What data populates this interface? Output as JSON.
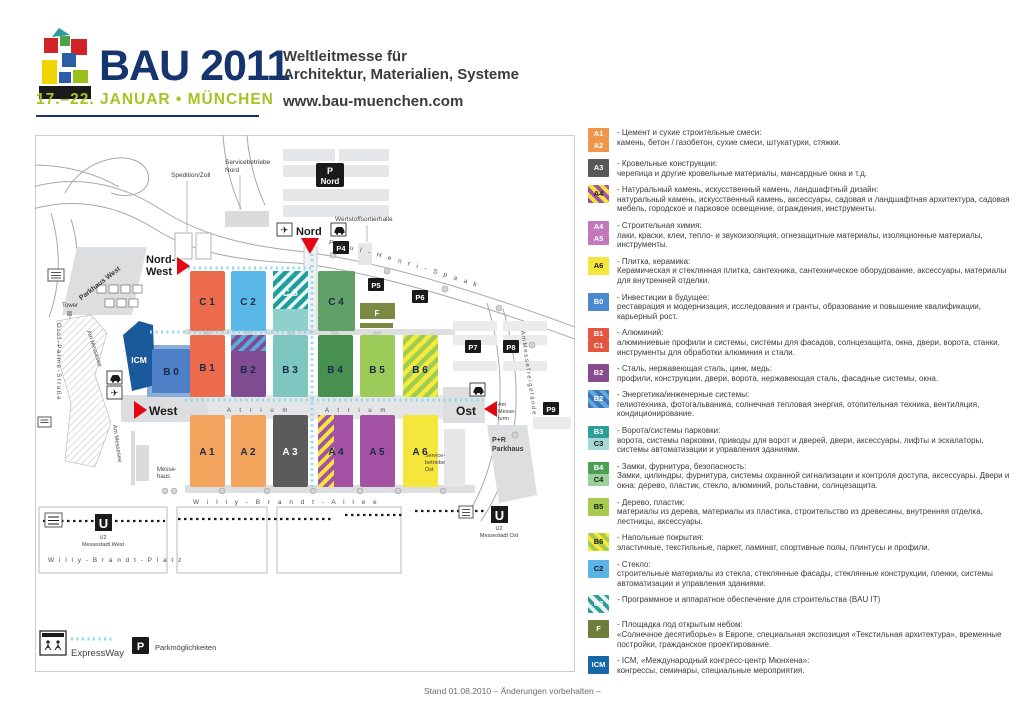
{
  "header": {
    "title": "BAU 2011",
    "dates": "17.–22. JANUAR • MÜNCHEN",
    "claim1": "Weltleitmesse für",
    "claim2": "Architektur, Materialien, Systeme",
    "website": "www.bau-muenchen.com"
  },
  "map": {
    "halls": {
      "c1": "C 1",
      "c2": "C 2",
      "c3": "C 3",
      "c4": "C 4",
      "b0": "B 0",
      "b1": "B 1",
      "b2": "B 2",
      "b3": "B 3",
      "b4": "B 4",
      "b5": "B 5",
      "b6": "B 6",
      "a1": "A 1",
      "a2": "A 2",
      "a3": "A 3",
      "a4": "A 4",
      "a5": "A 5",
      "a6": "A 6",
      "f": "F",
      "icm": "ICM"
    },
    "entrances": {
      "nordwest1": "Nord-",
      "nordwest2": "West",
      "nord": "Nord",
      "west": "West",
      "ost": "Ost"
    },
    "parking": {
      "p_nord1": "P",
      "p_nord2": "Nord",
      "p4": "P4",
      "p5": "P5",
      "p6": "P6",
      "p7": "P7",
      "p8": "P8",
      "p9": "P9",
      "pr1": "P+R",
      "pr2": "Parkhaus",
      "parkhaus_west": "Parkhaus West"
    },
    "streets": {
      "willy_brandt_allee": "W i l l y - B r a n d t - A l l e e",
      "willy_brandt_platz": "W i l l y - B r a n d t - P l a t z",
      "olof_palme": "O l o f - P a l m e - S t r a ß e",
      "paul_henri": "P a u l  -  H e n r i  -  S p a a k",
      "am_messesee": "Am Messesee",
      "am_messeturm1": "Am",
      "am_messeturm2": "Messe-",
      "am_messeturm3": "turm",
      "am_messefreigelaende": "A m  M e s s e f r e i g e l ä n d e",
      "atrium": "A t r i u m"
    },
    "places": {
      "spedition": "Spedition/Zoll",
      "serv_nord1": "Servicebetriebe",
      "serv_nord2": "Nord",
      "wertstoff": "Wertstoffsortierhalle",
      "serv_ost1": "Service-",
      "serv_ost2": "betriebe",
      "serv_ost3": "Ost",
      "messehaus1": "Messe-",
      "messehaus2": "haus",
      "tower": "Tower"
    },
    "stations": {
      "u": "U",
      "west1": "U2",
      "west2": "Messestadt West",
      "ost1": "U2",
      "ost2": "Messestadt Ost"
    },
    "map_legend": {
      "expressway": "ExpressWay",
      "p": "P",
      "parking": "Parkmöglichkeiten"
    }
  },
  "legend": {
    "items": [
      {
        "codes": [
          {
            "text": "A1",
            "bg": "#F0964A",
            "fg": "#FFFFFF"
          },
          {
            "text": "A2",
            "bg": "#F0964A",
            "fg": "#FFFFFF"
          }
        ],
        "title": "- Цемент и сухие строительные смеси:",
        "desc": "камень, бетон / газобетон, сухие смеси, штукатурки, стяжки."
      },
      {
        "codes": [
          {
            "text": "A3",
            "bg": "#58585A",
            "fg": "#FFFFFF"
          }
        ],
        "title": "- Кровельные конструкции:",
        "desc": "черепица и другие кровельные материалы, мансардные окна и т.д."
      },
      {
        "codes": [
          {
            "text": "A4",
            "bg": "repeating-linear-gradient(45deg,#A351A3 0px,#A351A3 4px,#F2E23D 4px,#F2E23D 8px)",
            "fg": "#1A1A1A"
          }
        ],
        "title": "- Натуральный камень, искусственный камень, ландшафтный дизайн:",
        "desc": "натуральный камень, искусственный камень, аксессуары, садовая и ландшафтная архитектура, садовая мебель, городское и парковое освещение, ограждения, инструменты."
      },
      {
        "codes": [
          {
            "text": "A4",
            "bg": "#C378BE",
            "fg": "#FFFFFF"
          },
          {
            "text": "A5",
            "bg": "#C378BE",
            "fg": "#FFFFFF"
          }
        ],
        "title": "- Строительная химия:",
        "desc": "лаки, краски, клеи, тепло- и звукоизоляция, огнезащитные материалы, изоляционные материалы, инструменты."
      },
      {
        "codes": [
          {
            "text": "A6",
            "bg": "#F5E63B",
            "fg": "#1A1A1A"
          }
        ],
        "title": "- Плитка, керамика:",
        "desc": "Керамическая и стеклянная плитка, сантехника, сантехническое оборудование, аксессуары, материалы для внутренней отделки."
      },
      {
        "codes": [
          {
            "text": "B0",
            "bg": "#4A89D0",
            "fg": "#FFFFFF"
          }
        ],
        "title": "- Инвестиции в будущее:",
        "desc": "реставрация и модернизация, исследования и гранты, образование и повышение квалификации, карьерный рост."
      },
      {
        "codes": [
          {
            "text": "B1",
            "bg": "#E65540",
            "fg": "#FFFFFF"
          },
          {
            "text": "C1",
            "bg": "#E65540",
            "fg": "#FFFFFF"
          }
        ],
        "title": "- Алюминий:",
        "desc": "алюминиевые профили и системы, системы для фасадов, солнцезащита, окна, двери, ворота, станки, инструменты для обработки алюминия и стали."
      },
      {
        "codes": [
          {
            "text": "B2",
            "bg": "#8A4A8E",
            "fg": "#FFFFFF"
          }
        ],
        "title": "- Сталь, нержавеющая сталь, цинк, медь:",
        "desc": "профили, конструкции, двери, ворота, нержавеющая сталь, фасадные системы, окна."
      },
      {
        "codes": [
          {
            "text": "B2",
            "bg": "repeating-linear-gradient(45deg,#4472B8 0px,#4472B8 4px,#5FAADE 4px,#5FAADE 8px)",
            "fg": "#FFFFFF"
          }
        ],
        "title": "- Энергетика/инженерные системы:",
        "desc": "гелиотехника, фотогальваника, солнечная тепловая энергия, отопительная техника, вентиляция, кондиционирование."
      },
      {
        "codes": [
          {
            "text": "B3",
            "bg": "#2E9E98",
            "fg": "#FFFFFF"
          },
          {
            "text": "C3",
            "bg": "#A5D8D2",
            "fg": "#1A1A1A"
          }
        ],
        "title": "- Ворота/системы парковки:",
        "desc": "ворота, системы парковки, приводы для ворот и дверей, двери, аксессуары, лифты и эскалаторы, системы автоматизации и управления зданиями."
      },
      {
        "codes": [
          {
            "text": "B4",
            "bg": "#4E9E53",
            "fg": "#FFFFFF"
          },
          {
            "text": "C4",
            "bg": "#9AD09A",
            "fg": "#1A1A1A"
          }
        ],
        "title": "- Замки, фурнитура, безопасность:",
        "desc": "Замки, цилиндры, фурнитура, системы охранной сигнализации и контроля доступа, аксессуары. Двери и окна: дерево, пластик, стекло, алюминий, рольставни, солнцезащита."
      },
      {
        "codes": [
          {
            "text": "B5",
            "bg": "#A6CB4E",
            "fg": "#1A1A1A"
          }
        ],
        "title": "- Дерево, пластик:",
        "desc": "материалы из дерева, материалы из пластика, строительство из древесины, внутренняя отделка, лестницы, аксессуары."
      },
      {
        "codes": [
          {
            "text": "B6",
            "bg": "repeating-linear-gradient(45deg,#F2E93C 0px,#F2E93C 4px,#A6CB4E 4px,#A6CB4E 8px)",
            "fg": "#1A1A1A"
          }
        ],
        "title": "- Напольные покрытия:",
        "desc": "эластичные, текстильные, паркет, ламинат, спортивные полы, плинтусы и профили."
      },
      {
        "codes": [
          {
            "text": "C2",
            "bg": "#5BB4E6",
            "fg": "#1A1A1A"
          }
        ],
        "title": "- Стекло:",
        "desc": "строительные материалы из стекла, стеклянные фасады, стеклянные конструкции, пленки, системы автоматизации и управления зданиями."
      },
      {
        "codes": [
          {
            "text": "C3",
            "bg": "repeating-linear-gradient(45deg,#2E9E98 0px,#2E9E98 4px,#E8F4F2 4px,#E8F4F2 8px)",
            "fg": "#FFFFFF"
          }
        ],
        "title": "- Программное и аппаратное обеспечение для строительства (BAU IT)",
        "desc": ""
      },
      {
        "codes": [
          {
            "text": "F",
            "bg": "#6E7D3C",
            "fg": "#FFFFFF"
          }
        ],
        "title": "- Площадка под открытым небом:",
        "desc": "«Солнечное десятиборье» в Европе, специальная экспозиция «Текстильная архитектура», временные постройки, гражданское проектирование."
      },
      {
        "codes": [
          {
            "text": "ICM",
            "bg": "#1668A8",
            "fg": "#FFFFFF"
          }
        ],
        "title": "- ICM, «Международный конгресс-центр Мюнхена»:",
        "desc": "конгрессы, семинары, специальные мероприятия."
      }
    ]
  },
  "footer": "Stand 01.08.2010 – Änderungen vorbehalten –"
}
